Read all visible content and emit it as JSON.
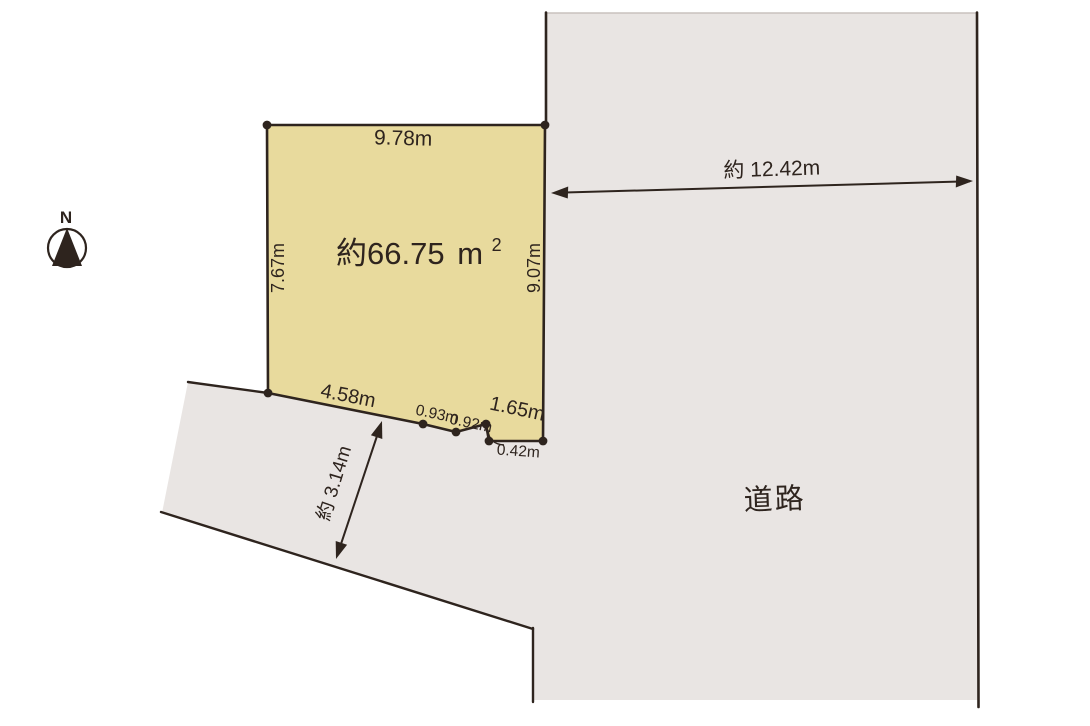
{
  "compass": {
    "north_label": "N"
  },
  "plot": {
    "area_value": "約66.75",
    "area_unit_base": "m",
    "area_unit_exponent": "2",
    "edge_top": "9.78m",
    "edge_left": "7.67m",
    "edge_right": "9.07m",
    "edge_bottom_segments": [
      "4.58m",
      "0.93m",
      "0.92m",
      "1.65m"
    ],
    "edge_bottom_step": "0.42m"
  },
  "road": {
    "label": "道路",
    "width_east": "約 12.42m",
    "width_south": "約 3.14m"
  },
  "colors": {
    "plot_fill": "#e8da9d",
    "road_fill": "#e9e5e3",
    "line": "#2e241e",
    "road_top_edge": "#c9c2be"
  }
}
